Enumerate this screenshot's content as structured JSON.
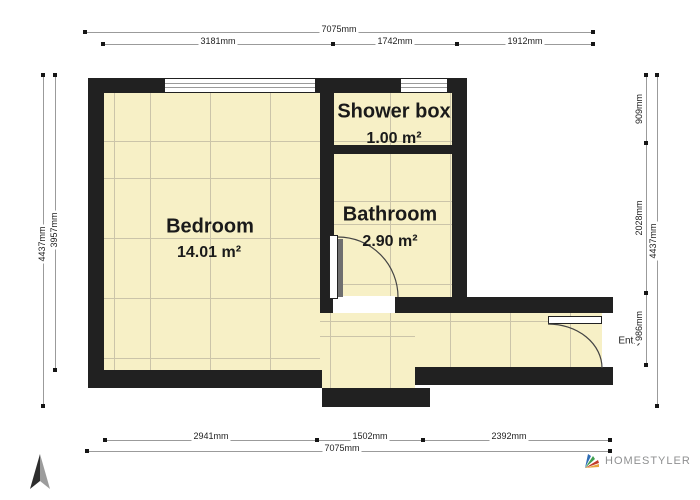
{
  "brand": {
    "name": "HOMESTYLER"
  },
  "rooms": {
    "bedroom": {
      "name": "Bedroom",
      "area": "14.01 m²"
    },
    "shower": {
      "name": "Shower box",
      "area": "1.00 m²"
    },
    "bathroom": {
      "name": "Bathroom",
      "area": "2.90 m²"
    }
  },
  "entry": {
    "label": "Entry"
  },
  "dims": {
    "top_total": "7075mm",
    "top_segments": [
      "3181mm",
      "1742mm",
      "1912mm"
    ],
    "bottom_segments": [
      "2941mm",
      "1502mm",
      "2392mm"
    ],
    "bottom_total": "7075mm",
    "left_outer": "4437mm",
    "left_inner": "3957mm",
    "right_segments": [
      "909mm",
      "2028mm",
      "986mm"
    ],
    "right_outer": "4437mm"
  },
  "colors": {
    "wall": "#212121",
    "floor": "#f7f0c6",
    "floor_grid": "#cbc4a9",
    "dimension_line": "#9b9b9b",
    "brand_text": "#8f9091",
    "logo_blue": "#2f6db5",
    "logo_green": "#3f9e4f",
    "logo_red": "#c23b2a",
    "logo_yellow": "#e8a33d"
  }
}
